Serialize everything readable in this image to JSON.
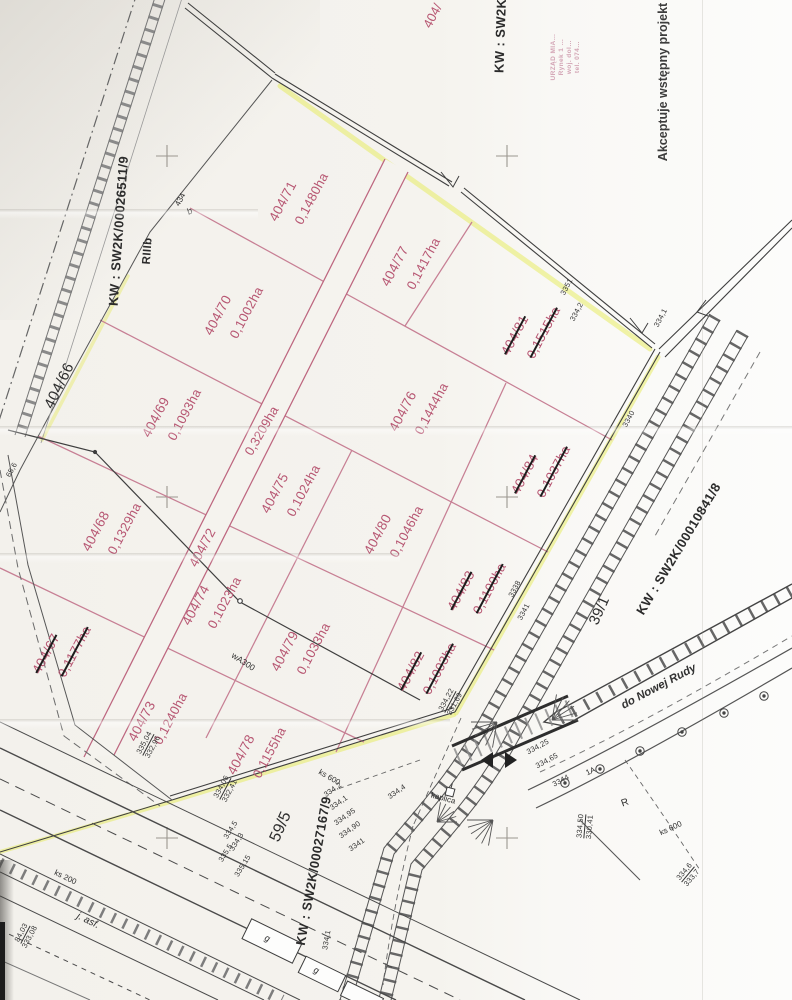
{
  "document": {
    "kind": "scanned cadastral subdivision sketch"
  },
  "annotations": {
    "kw_top_left": "KW : SW2K/00026511/9",
    "soil_class": "RIIIb",
    "parent_parcel": "404/66",
    "kw_top_center_partial": "KW : SW2K/0",
    "parcel_top_partial": "404/",
    "approval_note": "Akceptuje wstępny projekt",
    "kw_railway": "KW : SW2K/00010841/8",
    "kw_bottom": "KW : SW2K/00027167/9",
    "railway_parcel_595": "59/5",
    "railway_parcel_391": "39/1",
    "direction_note": "do Nowej Rudy",
    "road_surface": "j. asf.",
    "chapel": "kaplica",
    "utility_wa300": "wA300",
    "utility_ks600_a": "ks 600",
    "utility_ks200": "ks 200",
    "utility_ks600_b": "ks 600",
    "letter_g1": "g",
    "letter_g2": "g",
    "letter_R": "R",
    "point_1A": "1A",
    "point_434": "434",
    "point_b": "b"
  },
  "road": {
    "number": "404/72",
    "area": "0,3209ha"
  },
  "stamp": {
    "lines": [
      "URZĄD MIA…",
      "Rynek 1 …",
      "woj. dol…",
      "tel. 074…"
    ]
  },
  "parcels": [
    {
      "number": "404/71",
      "area": "0,1480ha",
      "struck": false,
      "x": 299,
      "y": 197,
      "r": -62
    },
    {
      "number": "404/77",
      "area": "0,1417ha",
      "struck": false,
      "x": 411,
      "y": 262,
      "r": -62
    },
    {
      "number": "404/81",
      "area": "0,1515ha",
      "struck": true,
      "x": 531,
      "y": 331,
      "r": -62
    },
    {
      "number": "404/70",
      "area": "0,1002ha",
      "struck": false,
      "x": 234,
      "y": 311,
      "r": -62
    },
    {
      "number": "404/76",
      "area": "0,1444ha",
      "struck": false,
      "x": 419,
      "y": 407,
      "r": -62
    },
    {
      "number": "404/84",
      "area": "0,1037ha",
      "struck": true,
      "x": 541,
      "y": 470,
      "r": -62
    },
    {
      "number": "404/69",
      "area": "0,1093ha",
      "struck": false,
      "x": 172,
      "y": 413,
      "r": -62
    },
    {
      "number": "404/75",
      "area": "0,1024ha",
      "struck": false,
      "x": 291,
      "y": 489,
      "r": -62
    },
    {
      "number": "404/80",
      "area": "0,1046ha",
      "struck": false,
      "x": 394,
      "y": 530,
      "r": -62
    },
    {
      "number": "404/83",
      "area": "0,1100ha",
      "struck": true,
      "x": 477,
      "y": 587,
      "r": -62
    },
    {
      "number": "404/68",
      "area": "0,1329ha",
      "struck": false,
      "x": 112,
      "y": 527,
      "r": -62
    },
    {
      "number": "404/74",
      "area": "0,1023ha",
      "struck": false,
      "x": 212,
      "y": 601,
      "r": -62
    },
    {
      "number": "404/79",
      "area": "0,1033ha",
      "struck": false,
      "x": 301,
      "y": 647,
      "r": -62
    },
    {
      "number": "404/82",
      "area": "0,1003ha",
      "struck": true,
      "x": 427,
      "y": 667,
      "r": -62
    },
    {
      "number": "404/67",
      "area": "0,1177ha",
      "struck": true,
      "x": 62,
      "y": 650,
      "r": -62
    },
    {
      "number": "404/73",
      "area": "0,1240ha",
      "struck": false,
      "x": 158,
      "y": 717,
      "r": -62
    },
    {
      "number": "404/78",
      "area": "0,1155ha",
      "struck": false,
      "x": 257,
      "y": 751,
      "r": -62
    }
  ],
  "tiny": [
    {
      "t": "334,2",
      "x": 577,
      "y": 312,
      "r": -62
    },
    {
      "t": "3351",
      "x": 567,
      "y": 287,
      "r": -62
    },
    {
      "t": "334,1",
      "x": 661,
      "y": 318,
      "r": -62
    },
    {
      "t": "3340",
      "x": 629,
      "y": 419,
      "r": -62
    },
    {
      "t": "3338",
      "x": 515,
      "y": 589,
      "r": -62
    },
    {
      "t": "3341",
      "x": 524,
      "y": 612,
      "r": -62
    },
    {
      "t": "334,22",
      "x": 447,
      "y": 700,
      "r": -62,
      "u": true
    },
    {
      "t": "331,69",
      "x": 455,
      "y": 704,
      "r": -62
    },
    {
      "t": "335,04",
      "x": 145,
      "y": 743,
      "r": -62,
      "u": true
    },
    {
      "t": "332,96",
      "x": 153,
      "y": 747,
      "r": -62
    },
    {
      "t": "334,06",
      "x": 222,
      "y": 787,
      "r": -62,
      "u": true
    },
    {
      "t": "332,41",
      "x": 230,
      "y": 791,
      "r": -62
    },
    {
      "t": "84,03",
      "x": 22,
      "y": 933,
      "r": -62,
      "u": true
    },
    {
      "t": "333,08",
      "x": 30,
      "y": 937,
      "r": -62
    },
    {
      "t": "334,50",
      "x": 581,
      "y": 826,
      "r": -85,
      "u": true
    },
    {
      "t": "330,41",
      "x": 590,
      "y": 827,
      "r": -85
    },
    {
      "t": "334,6",
      "x": 685,
      "y": 872,
      "r": -50,
      "u": true
    },
    {
      "t": "333,7",
      "x": 692,
      "y": 878,
      "r": -50
    },
    {
      "t": "334,5",
      "x": 231,
      "y": 830,
      "r": -58
    },
    {
      "t": "334,3",
      "x": 237,
      "y": 842,
      "r": -58
    },
    {
      "t": "335,5",
      "x": 226,
      "y": 853,
      "r": -58
    },
    {
      "t": "335,15",
      "x": 243,
      "y": 866,
      "r": -58
    },
    {
      "t": "334,2",
      "x": 333,
      "y": 790,
      "r": -35
    },
    {
      "t": "334,1",
      "x": 339,
      "y": 803,
      "r": -35
    },
    {
      "t": "334,95",
      "x": 345,
      "y": 817,
      "r": -35
    },
    {
      "t": "334,90",
      "x": 350,
      "y": 830,
      "r": -35
    },
    {
      "t": "334,4",
      "x": 397,
      "y": 792,
      "r": -35
    },
    {
      "t": "3341",
      "x": 357,
      "y": 845,
      "r": -35
    },
    {
      "t": "334,25",
      "x": 538,
      "y": 747,
      "r": -28
    },
    {
      "t": "334,65",
      "x": 547,
      "y": 761,
      "r": -28
    },
    {
      "t": "3344",
      "x": 561,
      "y": 781,
      "r": -28
    },
    {
      "t": "334,1",
      "x": 327,
      "y": 940,
      "r": -80
    },
    {
      "t": "65,6",
      "x": 12,
      "y": 470,
      "r": -62
    }
  ],
  "colors": {
    "parcel_line": "#c77f94",
    "parcel_text": "#b75672",
    "boundary_highlight": "#e6ec55",
    "linework": "#3f3f3f",
    "paper": "#f5f3ee"
  }
}
